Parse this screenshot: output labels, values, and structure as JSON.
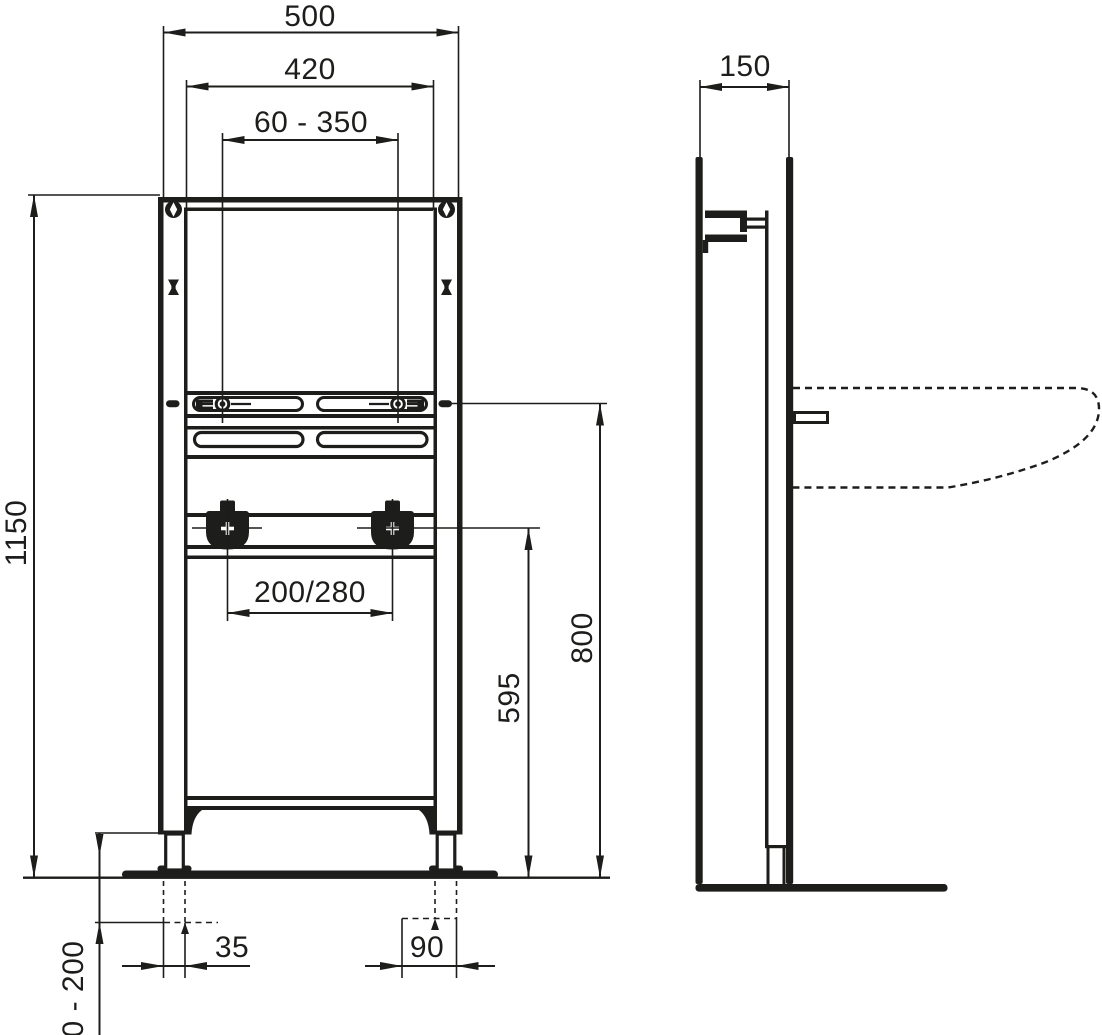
{
  "colors": {
    "line": "#1d1d1b",
    "background": "#ffffff"
  },
  "front_view": {
    "dimensions": {
      "overall_width": "500",
      "inner_width": "420",
      "fixture_spacing_range": "60 - 350",
      "frame_height": "1150",
      "fixture_height": "800",
      "drain_height": "595",
      "water_connection_spacing": "200/280",
      "foot_width": "35",
      "foot_anchor_spacing": "90",
      "leg_adjustment_range": "0 - 200"
    }
  },
  "side_view": {
    "dimensions": {
      "frame_depth": "150"
    }
  }
}
